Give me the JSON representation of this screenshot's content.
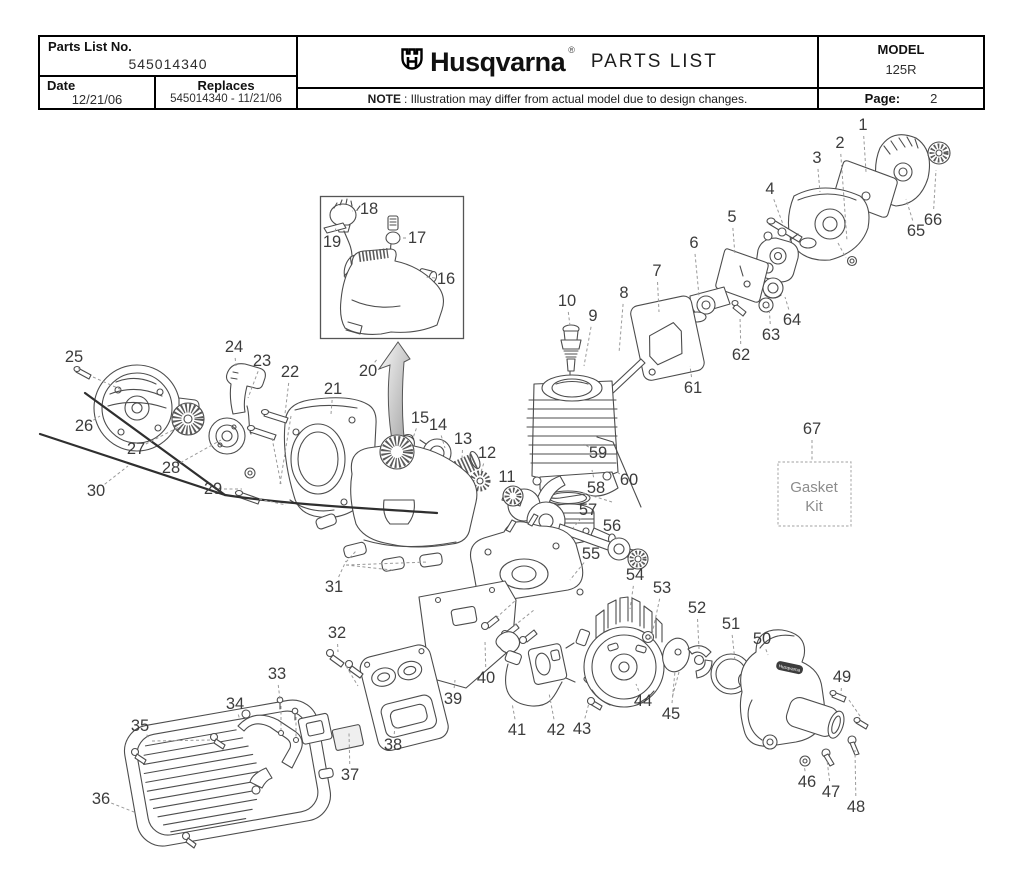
{
  "header": {
    "parts_list_label": "Parts List No.",
    "parts_list_no": "545014340",
    "date_label": "Date",
    "date_value": "12/21/06",
    "replaces_label": "Replaces",
    "replaces_value": "545014340 - 11/21/06",
    "brand": "Husqvarna",
    "registered_mark": "®",
    "doc_title": "PARTS LIST",
    "note_label": "NOTE",
    "note_text": ": Illustration may differ from actual model due to design changes.",
    "model_label": "MODEL",
    "model_value": "125R",
    "page_label": "Page:",
    "page_value": "2"
  },
  "diagram": {
    "gasket_kit": {
      "line1": "Gasket",
      "line2": "Kit"
    },
    "housing_label": "Husqvarna",
    "callouts": [
      {
        "n": "1",
        "x": 863,
        "y": 125,
        "tx": 866,
        "ty": 172
      },
      {
        "n": "2",
        "x": 840,
        "y": 143,
        "tx": 847,
        "ty": 241
      },
      {
        "n": "3",
        "x": 817,
        "y": 158,
        "tx": 820,
        "ty": 192
      },
      {
        "n": "4",
        "x": 770,
        "y": 189,
        "tx": 784,
        "ty": 227
      },
      {
        "n": "5",
        "x": 732,
        "y": 217,
        "tx": 735,
        "ty": 255
      },
      {
        "n": "6",
        "x": 694,
        "y": 243,
        "tx": 699,
        "ty": 296
      },
      {
        "n": "7",
        "x": 657,
        "y": 271,
        "tx": 659,
        "ty": 312
      },
      {
        "n": "8",
        "x": 624,
        "y": 293,
        "tx": 619,
        "ty": 353
      },
      {
        "n": "9",
        "x": 593,
        "y": 316,
        "tx": 584,
        "ty": 366
      },
      {
        "n": "10",
        "x": 567,
        "y": 301,
        "tx": 570,
        "ty": 326
      },
      {
        "n": "11",
        "x": 507,
        "y": 477,
        "tx": 509,
        "ty": 488
      },
      {
        "n": "12",
        "x": 487,
        "y": 453,
        "tx": 480,
        "ty": 475
      },
      {
        "n": "13",
        "x": 463,
        "y": 439,
        "tx": 462,
        "ty": 459
      },
      {
        "n": "14",
        "x": 438,
        "y": 425,
        "tx": 445,
        "ty": 448
      },
      {
        "n": "15",
        "x": 420,
        "y": 418,
        "tx": 413,
        "ty": 438
      },
      {
        "n": "16",
        "x": 446,
        "y": 279,
        "tx": 425,
        "ty": 277
      },
      {
        "n": "17",
        "x": 417,
        "y": 238,
        "tx": 399,
        "ty": 238
      },
      {
        "n": "18",
        "x": 369,
        "y": 209,
        "tx": 352,
        "ty": 211
      },
      {
        "n": "19",
        "x": 332,
        "y": 242,
        "tx": 336,
        "ty": 228
      },
      {
        "n": "20",
        "x": 368,
        "y": 371,
        "tx": 378,
        "ty": 358
      },
      {
        "n": "21",
        "x": 333,
        "y": 389,
        "tx": 331,
        "ty": 414
      },
      {
        "n": "22",
        "x": 290,
        "y": 372,
        "tx": 285,
        "ty": 414
      },
      {
        "n": "23",
        "x": 262,
        "y": 361,
        "tx": 248,
        "ty": 398
      },
      {
        "n": "24",
        "x": 234,
        "y": 347,
        "tx": 236,
        "ty": 366
      },
      {
        "n": "25",
        "x": 74,
        "y": 357,
        "tx": 80,
        "ty": 371
      },
      {
        "n": "26",
        "x": 84,
        "y": 426,
        "tx": 100,
        "ty": 416
      },
      {
        "n": "27",
        "x": 136,
        "y": 449,
        "tx": 181,
        "ty": 426
      },
      {
        "n": "28",
        "x": 171,
        "y": 468,
        "tx": 221,
        "ty": 440
      },
      {
        "n": "29",
        "x": 213,
        "y": 489,
        "tx": 242,
        "ty": 489
      },
      {
        "n": "30",
        "x": 96,
        "y": 491,
        "tx": 128,
        "ty": 466
      },
      {
        "n": "31",
        "x": 334,
        "y": 587,
        "tx": 346,
        "ty": 561
      },
      {
        "n": "32",
        "x": 337,
        "y": 633,
        "tx": 338,
        "ty": 652
      },
      {
        "n": "33",
        "x": 277,
        "y": 674,
        "tx": 280,
        "ty": 700
      },
      {
        "n": "34",
        "x": 235,
        "y": 704,
        "tx": 240,
        "ty": 720
      },
      {
        "n": "35",
        "x": 140,
        "y": 726,
        "tx": 150,
        "ty": 739
      },
      {
        "n": "36",
        "x": 101,
        "y": 799,
        "tx": 134,
        "ty": 812
      },
      {
        "n": "37",
        "x": 350,
        "y": 775,
        "tx": 349,
        "ty": 733
      },
      {
        "n": "38",
        "x": 393,
        "y": 745,
        "tx": 395,
        "ty": 727
      },
      {
        "n": "39",
        "x": 453,
        "y": 699,
        "tx": 455,
        "ty": 680
      },
      {
        "n": "40",
        "x": 486,
        "y": 678,
        "tx": 485,
        "ty": 641
      },
      {
        "n": "41",
        "x": 517,
        "y": 730,
        "tx": 512,
        "ty": 703
      },
      {
        "n": "42",
        "x": 556,
        "y": 730,
        "tx": 549,
        "ty": 693
      },
      {
        "n": "43",
        "x": 582,
        "y": 729,
        "tx": 589,
        "ty": 703
      },
      {
        "n": "44",
        "x": 643,
        "y": 701,
        "tx": 636,
        "ty": 684
      },
      {
        "n": "45",
        "x": 671,
        "y": 714,
        "tx": 675,
        "ty": 671
      },
      {
        "n": "46",
        "x": 807,
        "y": 782,
        "tx": 804,
        "ty": 765
      },
      {
        "n": "47",
        "x": 831,
        "y": 792,
        "tx": 827,
        "ty": 760
      },
      {
        "n": "48",
        "x": 856,
        "y": 807,
        "tx": 855,
        "ty": 750
      },
      {
        "n": "49",
        "x": 842,
        "y": 677,
        "tx": 841,
        "ty": 694
      },
      {
        "n": "50",
        "x": 762,
        "y": 639,
        "tx": 768,
        "ty": 655
      },
      {
        "n": "51",
        "x": 731,
        "y": 624,
        "tx": 735,
        "ty": 661
      },
      {
        "n": "52",
        "x": 697,
        "y": 608,
        "tx": 699,
        "ty": 649
      },
      {
        "n": "53",
        "x": 662,
        "y": 588,
        "tx": 651,
        "ty": 639
      },
      {
        "n": "54",
        "x": 635,
        "y": 575,
        "tx": 630,
        "ty": 609
      },
      {
        "n": "55",
        "x": 591,
        "y": 554,
        "tx": 570,
        "ty": 580
      },
      {
        "n": "56",
        "x": 612,
        "y": 526,
        "tx": 617,
        "ty": 541
      },
      {
        "n": "57",
        "x": 588,
        "y": 510,
        "tx": 573,
        "ty": 528
      },
      {
        "n": "58",
        "x": 596,
        "y": 488,
        "tx": 592,
        "ty": 470
      },
      {
        "n": "59",
        "x": 598,
        "y": 453,
        "tx": 584,
        "ty": 444
      },
      {
        "n": "60",
        "x": 629,
        "y": 480,
        "tx": 617,
        "ty": 472
      },
      {
        "n": "61",
        "x": 693,
        "y": 388,
        "tx": 690,
        "ty": 366
      },
      {
        "n": "62",
        "x": 741,
        "y": 355,
        "tx": 740,
        "ty": 317
      },
      {
        "n": "63",
        "x": 771,
        "y": 335,
        "tx": 769,
        "ty": 306
      },
      {
        "n": "64",
        "x": 792,
        "y": 320,
        "tx": 785,
        "ty": 297
      },
      {
        "n": "65",
        "x": 916,
        "y": 231,
        "tx": 906,
        "ty": 199
      },
      {
        "n": "66",
        "x": 933,
        "y": 220,
        "tx": 936,
        "ty": 170
      },
      {
        "n": "67",
        "x": 812,
        "y": 429,
        "tx": 812,
        "ty": 460
      }
    ]
  }
}
